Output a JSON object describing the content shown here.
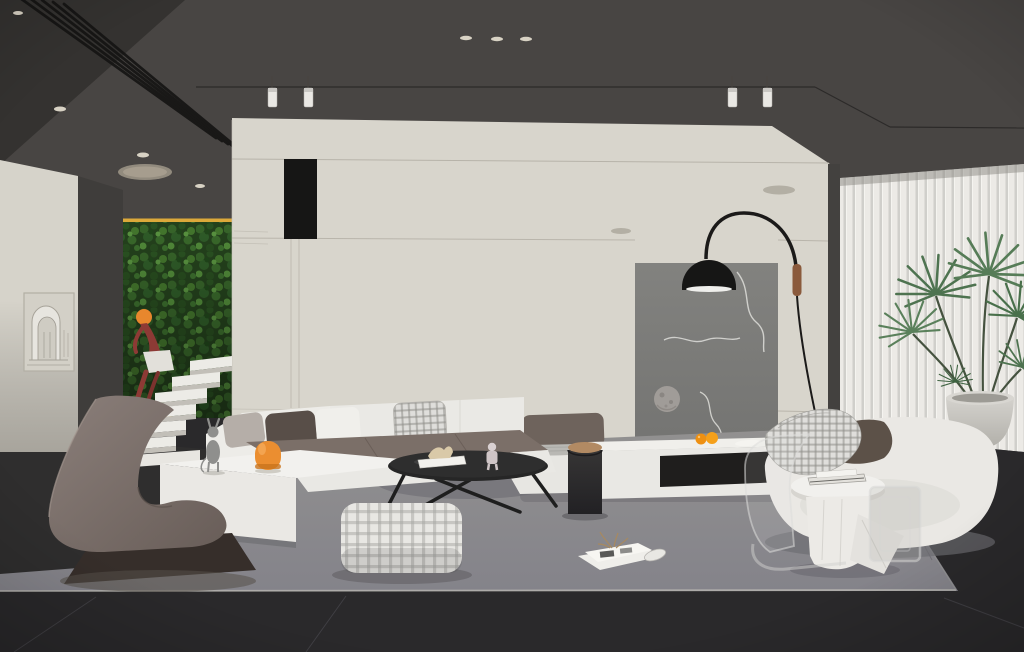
{
  "meta": {
    "title": "Modern living room — 3D interior render",
    "render_style": "architectural visualization",
    "canvas_width": 1024,
    "canvas_height": 652
  },
  "palette": {
    "ceiling": "#484543",
    "ceiling_corner": "#343230",
    "wall_cream": "#d8d5cc",
    "wall_left": "#d6d3ca",
    "corridor_wall": "#3f3d3b",
    "accent_panel": "#7d7d7b",
    "green_wall": "#26451e",
    "blinds": "#eceae6",
    "floor_tile": "#2a292b",
    "rug": "#8b8a8c",
    "sofa_white": "#ecebe7",
    "sofa_seat": "#7b6f68",
    "bench_backrest": "#6e635c",
    "lounge_chair": "#7d716c",
    "lamp_black": "#1b1a19",
    "wood_accent": "#8a5a3c",
    "orange_accent": "#ee9012",
    "amber_light": "#dca93a",
    "figure_red": "#8d3a35",
    "plant_green": "#4e7350",
    "pot_gray": "#c8c6c0",
    "cat_gray": "#8f8f8d"
  },
  "lighting": {
    "recessed_downlights": 7,
    "track_spotlights": 4,
    "oval_ceiling_fixture": 1,
    "amber_strip_lights": 2,
    "arc_floor_lamp": 1
  },
  "scene": {
    "description": "Minimalist double-height living room: vertical moss garden with floating stairs and red acrobat sculpture, cream walls, gray accent art panel, modular white sofa with taupe seats, black arc lamp, vertical blinds and indoor palm",
    "objects": [
      {
        "id": "ceiling",
        "label": "dark gray ceiling with louvered vent and downlights"
      },
      {
        "id": "louver-vent",
        "label": "diagonal black louver strip"
      },
      {
        "id": "track-spotlights",
        "label": "wire-mounted cylinder spotlights"
      },
      {
        "id": "arch-artwork",
        "label": "framed plaster arch relief artwork"
      },
      {
        "id": "green-wall",
        "label": "vertical garden wall with amber strip light"
      },
      {
        "id": "stairs",
        "label": "white floating stair treads"
      },
      {
        "id": "acrobat-figure",
        "label": "red acrobat sculpture with orange ball"
      },
      {
        "id": "main-wall",
        "label": "cream feature wall with black slot reveal"
      },
      {
        "id": "accent-panel",
        "label": "gray panel with abstract line art and moon sphere"
      },
      {
        "id": "arc-lamp",
        "label": "black arc floor lamp with walnut grip"
      },
      {
        "id": "blinds",
        "label": "white vertical blinds"
      },
      {
        "id": "palm-plant",
        "label": "potted fan palm"
      },
      {
        "id": "sofa",
        "label": "white modular sofa with taupe seat cushions"
      },
      {
        "id": "pillows",
        "label": "white, gray, brown and houndstooth pillows"
      },
      {
        "id": "cat-sculpture",
        "label": "gray cat figurine"
      },
      {
        "id": "orange-lamp",
        "label": "orange arch table lamp"
      },
      {
        "id": "coffee-table",
        "label": "black oval coffee table with books and figurines"
      },
      {
        "id": "cylinder-table",
        "label": "black cylinder side table with wood top"
      },
      {
        "id": "bench",
        "label": "white daybed bench with marble top and taupe backrest"
      },
      {
        "id": "media-console",
        "label": "white media console with open niche, oranges and leaf dish"
      },
      {
        "id": "pouf",
        "label": "gingham check pouf"
      },
      {
        "id": "magazine",
        "label": "open magazine with dried sprig"
      },
      {
        "id": "chaise",
        "label": "white chaise lounge with taupe cushion and check throw"
      },
      {
        "id": "side-table",
        "label": "white round side table with magazines"
      },
      {
        "id": "drape-table",
        "label": "sculptural white drape table"
      },
      {
        "id": "ghost-chair",
        "label": "transparent acrylic chair"
      },
      {
        "id": "acrylic-frame",
        "label": "translucent acrylic side frame"
      },
      {
        "id": "lounge-chair",
        "label": "brown cantilever ribbon lounge chair"
      },
      {
        "id": "rug",
        "label": "gray area rug"
      },
      {
        "id": "floor",
        "label": "dark stone tile floor"
      }
    ]
  }
}
